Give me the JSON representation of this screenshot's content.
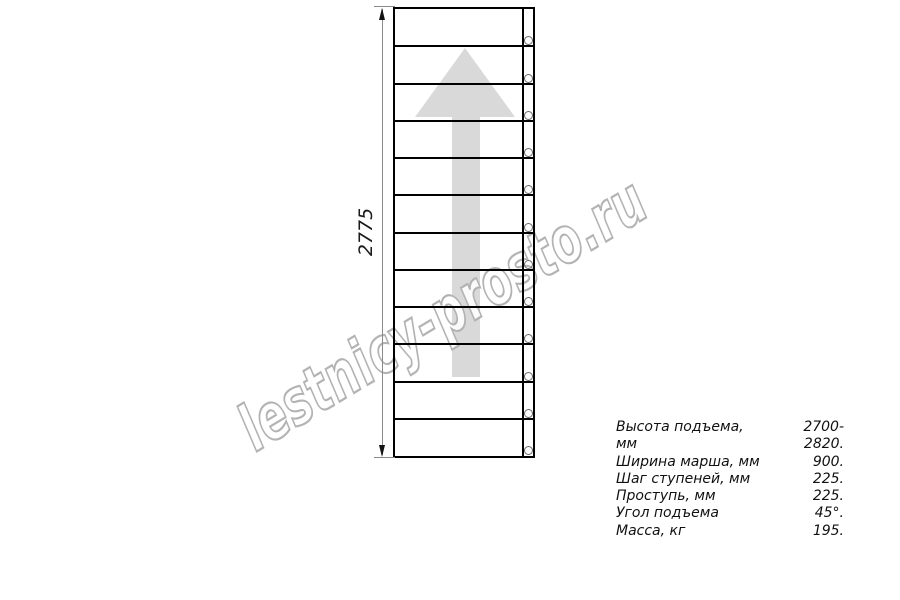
{
  "watermark": {
    "text": "lestnicy-prosto.ru",
    "stroke_color": "#b3b3b3"
  },
  "dimension": {
    "height_label": "2775"
  },
  "staircase": {
    "step_count": 12,
    "bolt_count": 12
  },
  "arrow": {
    "direction": "up",
    "fill_color": "#d9d9d9"
  },
  "specs": {
    "rows": [
      {
        "label": "Высота подъема, мм",
        "value": "2700-2820."
      },
      {
        "label": "Ширина марша, мм",
        "value": "900."
      },
      {
        "label": "Шаг ступеней, мм",
        "value": "225."
      },
      {
        "label": "Проступь, мм",
        "value": "225."
      },
      {
        "label": "Угол подъема",
        "value": "45°."
      },
      {
        "label": "Масса, кг",
        "value": "195."
      }
    ]
  },
  "colors": {
    "line": "#000000",
    "dim_line": "#8a8a8a"
  }
}
